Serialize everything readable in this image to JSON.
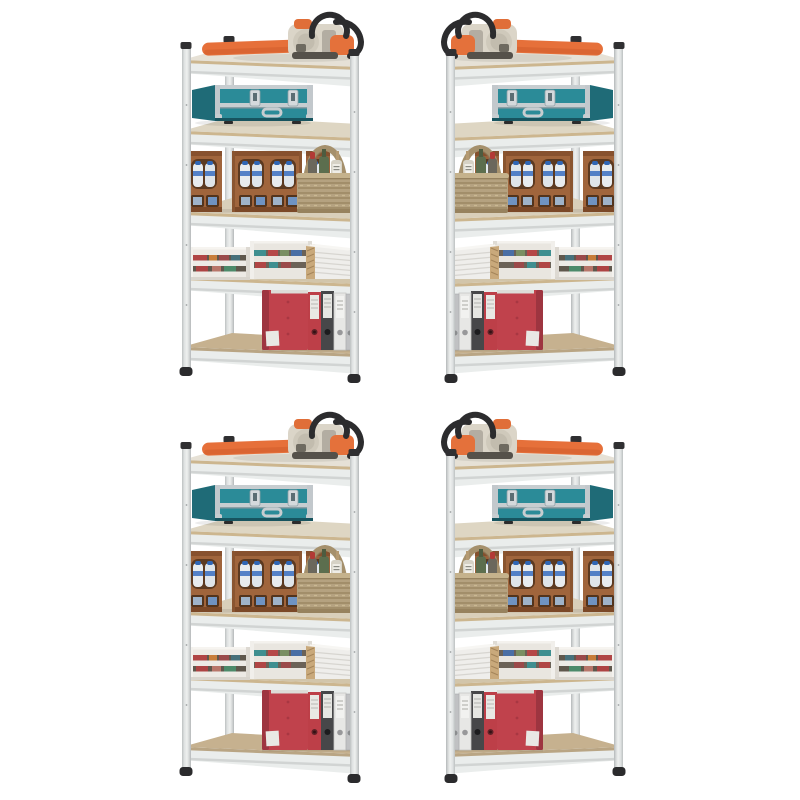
{
  "image": {
    "kind": "product photo",
    "background_color": "#ffffff",
    "description": "Four identical galvanized steel 5-tier boltless storage shelving units shown in a 2x2 grid on a white background; the right-hand units are mirror images of the left-hand units. Each rack holds: an orange and cream chainsaw on the top shelf, a teal aluminium flight case on the second shelf, brown bottle crates with water bottles and a wicker basket on the third shelf, white wooden crates and a stack of folded cardboard on the fourth shelf, and red, black, white and grey lever-arch binders on the bottom shelf.",
    "grid": {
      "rows": 2,
      "columns": 2
    }
  },
  "shelving_unit": {
    "shelf_count": 5,
    "frame": {
      "material": "galvanized steel",
      "post_color": "#d9dcdc",
      "cap_and_foot_color": "#2e2e30",
      "shelf_face_color": "#eaedec",
      "mdf_edge_color": "#ccb68f",
      "bottom_shelf_surface_color": "#c6b18f"
    },
    "shelves": [
      {
        "index": 1,
        "position": "top",
        "items": [
          {
            "name": "chainsaw",
            "colors": [
              "#e6703a",
              "#dbd5c8",
              "#2c2c2e"
            ]
          }
        ]
      },
      {
        "index": 2,
        "items": [
          {
            "name": "teal aluminium flight case",
            "colors": [
              "#2b8b98",
              "#c7cdd0",
              "#1f6b77"
            ]
          }
        ]
      },
      {
        "index": 3,
        "items": [
          {
            "name": "bottle crates with water bottles",
            "count": 3,
            "colors": [
              "#a0653c",
              "#e8ecef",
              "#2f66b5"
            ]
          },
          {
            "name": "wicker basket with bottles",
            "colors": [
              "#b5a280",
              "#5c6e4e",
              "#b23a35"
            ]
          }
        ]
      },
      {
        "index": 4,
        "items": [
          {
            "name": "white wooden crates",
            "count": 2,
            "colors": [
              "#edeae5",
              "#b04545",
              "#3f8f90"
            ]
          },
          {
            "name": "folded cardboard stack",
            "colors": [
              "#efeeeb",
              "#c9a97b"
            ]
          }
        ]
      },
      {
        "index": 5,
        "position": "bottom",
        "items": [
          {
            "name": "lever-arch binders",
            "count": 5,
            "colors": [
              "#c0424c",
              "#bd3f48",
              "#474749",
              "#e7e7e5",
              "#c0c1c3"
            ]
          }
        ]
      }
    ]
  },
  "units": [
    {
      "id": "top-left",
      "mirrored": false
    },
    {
      "id": "top-right",
      "mirrored": true
    },
    {
      "id": "bottom-left",
      "mirrored": false
    },
    {
      "id": "bottom-right",
      "mirrored": true
    }
  ]
}
